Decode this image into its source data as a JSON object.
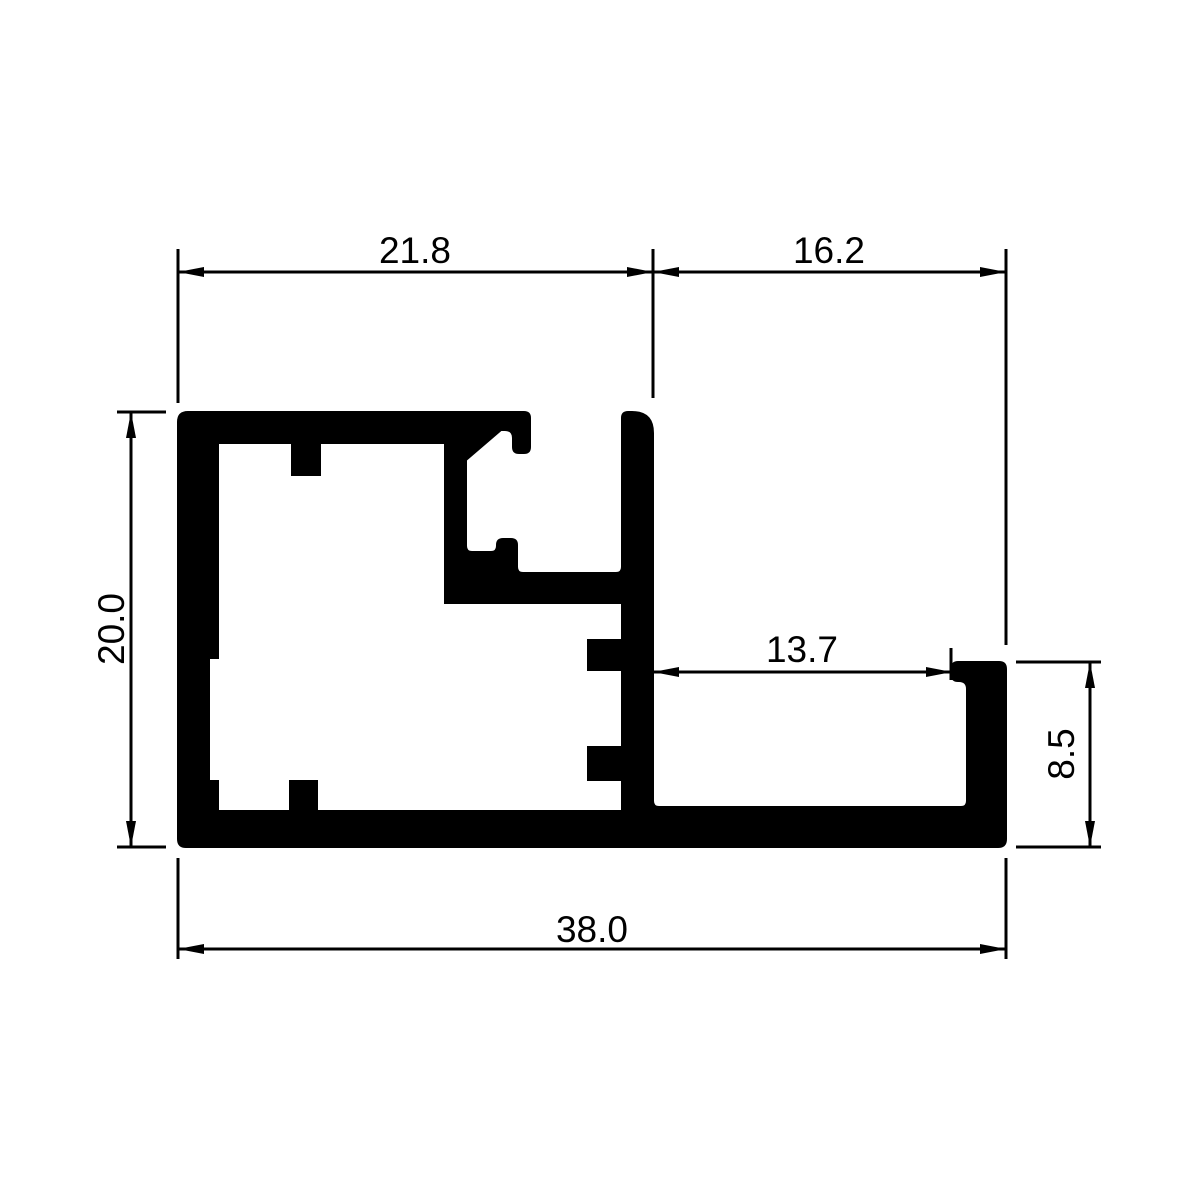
{
  "drawing": {
    "kind": "aluminium-profile-cross-section",
    "colors": {
      "line": "#000000",
      "fill": "#000000",
      "background": "#ffffff"
    },
    "dimensions": {
      "top_left_width": "21.8",
      "top_right_width": "16.2",
      "left_height": "20.0",
      "sill_opening_width": "13.7",
      "right_height": "8.5",
      "total_width": "38.0"
    }
  }
}
